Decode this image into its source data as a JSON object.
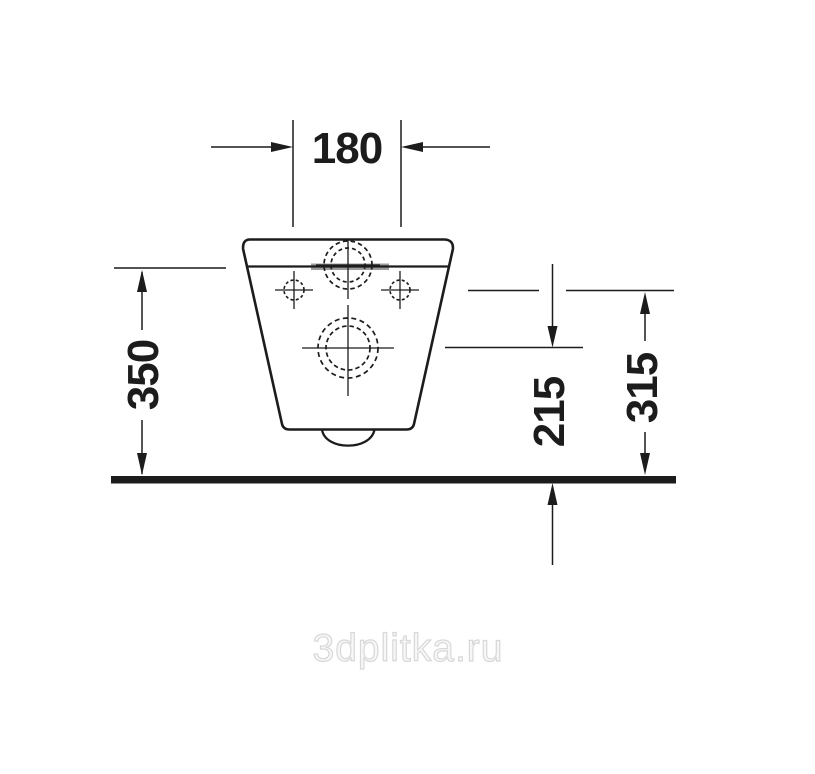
{
  "drawing": {
    "dimension_labels": {
      "top_width": "180",
      "left_height": "350",
      "right_inner_height": "215",
      "right_outer_height": "315"
    }
  },
  "watermark": {
    "text": "3dplitka.ru"
  }
}
